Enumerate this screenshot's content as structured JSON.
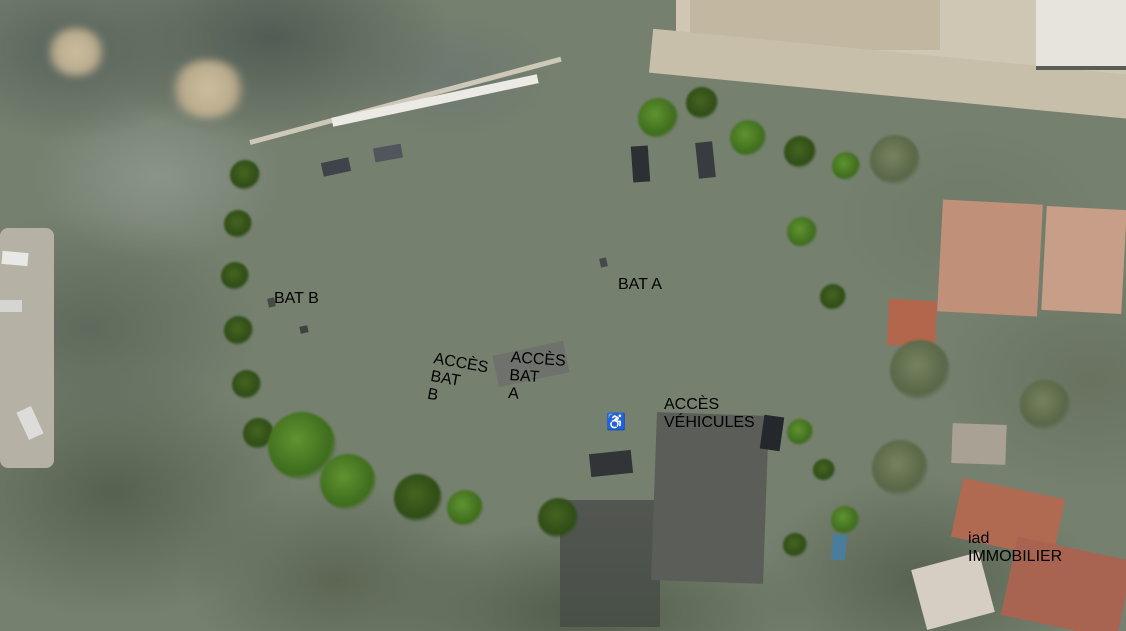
{
  "site_plan": {
    "buildings": [
      {
        "label": "BAT A"
      },
      {
        "label": "BAT B"
      }
    ],
    "signs": {
      "access_bat_b": "ACCÈS\nBAT B",
      "access_bat_a": "ACCÈS\nBAT A",
      "access_vehicles": "ACCÈS\nVÉHICULES"
    },
    "markings": {
      "disabled_parking_icon": "♿"
    }
  },
  "branding": {
    "logo_text": "iad",
    "logo_subtext": "IMMOBILIER"
  },
  "colors": {
    "lawn_green": "#6ba12d",
    "roof_terracotta": "#b5532e",
    "sign_red": "#c41e2f",
    "sign_blue": "#2c82c6",
    "asphalt_gray": "#535652",
    "solar_panel_blue": "#32476f"
  }
}
